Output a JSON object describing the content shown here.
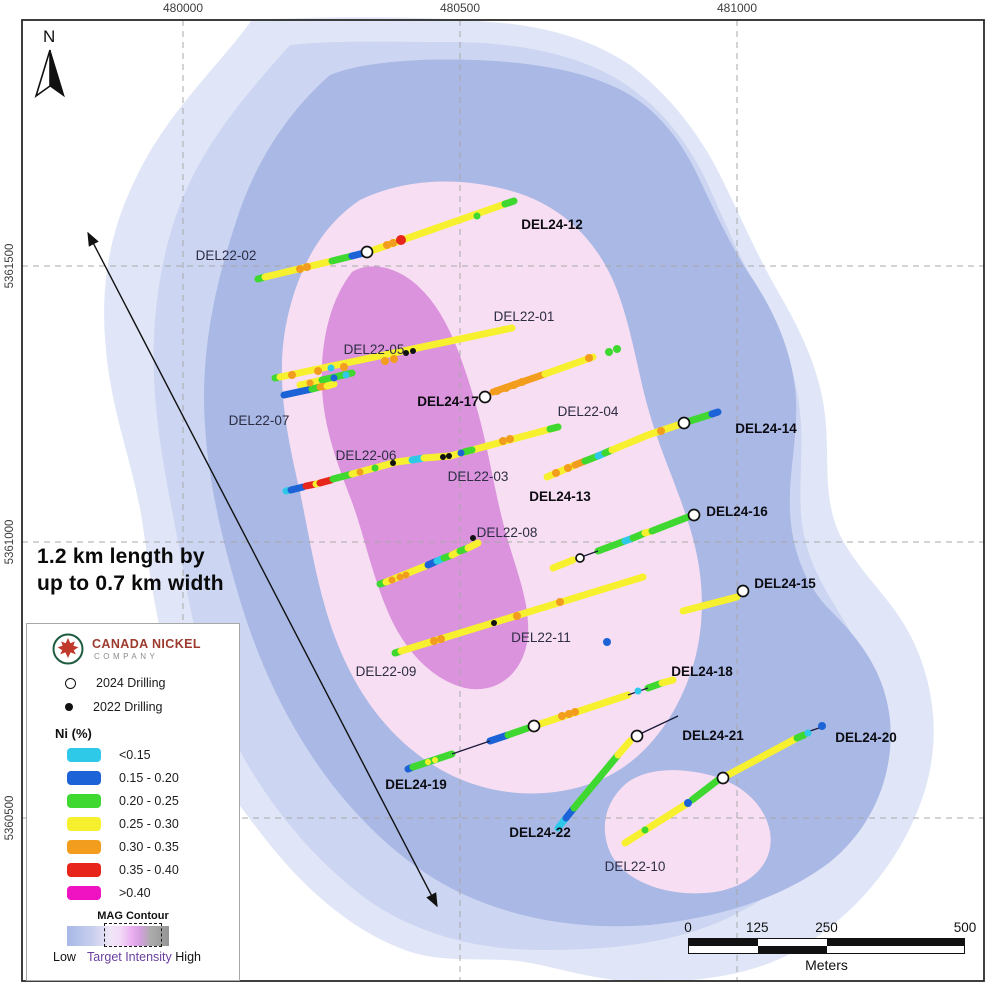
{
  "map": {
    "annotation": {
      "line1": "1.2 km length by",
      "line2": "up to 0.7 km width"
    },
    "north_label": "N",
    "axes": {
      "top_ticks": [
        {
          "label": "480000",
          "x": 183
        },
        {
          "label": "480500",
          "x": 460
        },
        {
          "label": "481000",
          "x": 737
        }
      ],
      "left_ticks": [
        {
          "label": "5361500",
          "y": 266
        },
        {
          "label": "5361000",
          "y": 542
        },
        {
          "label": "5360500",
          "y": 818
        }
      ]
    },
    "gridlines": {
      "vertical_x": [
        183,
        460,
        737
      ],
      "horizontal_y": [
        266,
        542,
        818
      ],
      "color": "#a9a9a9"
    },
    "frame": {
      "x": 22,
      "y": 20,
      "w": 962,
      "h": 961,
      "color": "#2a2a2a"
    },
    "arrow": {
      "x1": 88,
      "y1": 233,
      "x2": 437,
      "y2": 906
    },
    "class_colors": {
      "cyan": "#2ec9e9",
      "blue": "#1b63d6",
      "green": "#3ed830",
      "yellow": "#f7f02e",
      "orange": "#f29d1d",
      "red": "#e8251a",
      "magenta": "#f013c2",
      "black": "#111111"
    },
    "contours": [
      {
        "name": "mag-outer",
        "color": "#e0e6f7",
        "path": "M252,20 C215,70 165,115 135,180 C108,235 100,290 106,350 C112,415 132,460 142,520 C150,575 158,640 180,700 C200,755 235,800 270,845 C305,888 350,930 405,950 C445,965 490,956 525,962 C560,968 600,982 645,982 C700,982 760,975 805,945 C860,910 905,855 925,790 C940,740 935,690 915,645 C895,600 860,575 840,535 C822,498 830,455 825,415 C820,370 800,330 780,295 C758,258 740,215 720,175 C700,135 670,95 630,65 C590,38 540,25 490,22 C420,16 330,16 252,20 Z"
      },
      {
        "name": "mag-light",
        "color": "#ccd5f1",
        "path": "M290,45 C250,90 205,140 180,205 C158,262 150,330 155,395 C160,462 175,520 185,580 C196,645 215,705 245,760 C275,812 315,860 365,898 C415,934 478,950 540,950 C605,950 670,945 728,918 C785,890 838,848 865,790 C888,740 882,688 858,645 C838,608 815,580 805,540 C795,498 805,455 800,412 C795,365 778,325 758,290 C738,255 722,215 705,178 C685,138 658,105 622,82 C575,52 510,42 450,42 C390,42 335,40 290,45 Z"
      },
      {
        "name": "mag-medium",
        "color": "#a9b8e4",
        "path": "M330,75 C290,110 255,160 235,225 C215,285 200,355 205,425 C208,480 222,540 240,600 C258,660 285,720 325,775 C362,825 410,870 465,895 C520,920 585,930 650,925 C715,918 780,900 830,862 C872,828 895,775 890,720 C885,672 860,640 830,610 C805,585 792,550 790,512 C788,470 800,430 795,388 C790,345 772,308 750,275 C728,242 712,205 695,170 C676,132 648,100 610,85 C560,62 480,58 420,60 C385,62 355,65 330,75 Z"
      },
      {
        "name": "mag-target-pink",
        "color": "#f8def2",
        "path": "M360,200 C318,228 295,275 285,330 C276,385 288,440 300,492 C310,540 318,595 338,645 C360,700 395,745 445,772 C492,797 548,800 595,782 C640,765 672,725 690,675 C706,630 705,580 692,535 C680,492 660,452 648,408 C636,365 630,318 612,278 C592,235 558,205 515,192 C462,176 405,178 360,200 Z"
      },
      {
        "name": "mag-target-pink-south",
        "color": "#f8def2",
        "path": "M628,782 C605,800 598,830 612,856 C628,884 672,898 715,892 C752,886 775,862 770,832 C764,800 735,778 695,772 C670,768 645,770 628,782 Z"
      },
      {
        "name": "mag-core",
        "color": "#da93dc",
        "path": "M352,272 C330,300 320,342 322,388 C324,430 338,465 352,502 C364,535 372,575 388,612 C404,650 432,680 465,688 C498,695 525,672 528,635 C530,600 515,568 505,530 C494,490 488,445 475,402 C462,358 448,315 420,288 C400,268 372,260 352,272 Z"
      }
    ],
    "traces": {
      "segments": [
        [
          258,
          279,
          265,
          277,
          "green"
        ],
        [
          265,
          277,
          332,
          261,
          "yellow"
        ],
        [
          332,
          261,
          352,
          256,
          "green"
        ],
        [
          352,
          256,
          364,
          253,
          "blue"
        ],
        [
          371,
          251,
          505,
          204,
          "yellow"
        ],
        [
          505,
          204,
          514,
          201,
          "green"
        ],
        [
          275,
          378,
          280,
          377,
          "green"
        ],
        [
          280,
          377,
          512,
          328,
          "yellow"
        ],
        [
          300,
          385,
          322,
          380,
          "yellow"
        ],
        [
          322,
          380,
          352,
          373,
          "green"
        ],
        [
          284,
          395,
          312,
          389,
          "blue"
        ],
        [
          312,
          389,
          320,
          387,
          "green"
        ],
        [
          320,
          387,
          327,
          386,
          "orange"
        ],
        [
          327,
          386,
          334,
          384,
          "yellow"
        ],
        [
          493,
          392,
          545,
          374,
          "orange"
        ],
        [
          545,
          374,
          593,
          357,
          "yellow"
        ],
        [
          286,
          491,
          291,
          490,
          "cyan"
        ],
        [
          291,
          490,
          303,
          487,
          "blue"
        ],
        [
          306,
          486,
          316,
          484,
          "red"
        ],
        [
          316,
          484,
          320,
          483,
          "yellow"
        ],
        [
          320,
          483,
          331,
          480,
          "red"
        ],
        [
          333,
          479,
          352,
          474,
          "green"
        ],
        [
          352,
          474,
          393,
          463,
          "yellow"
        ],
        [
          396,
          462,
          412,
          460,
          "yellow"
        ],
        [
          412,
          460,
          424,
          458,
          "cyan"
        ],
        [
          424,
          458,
          450,
          456,
          "yellow"
        ],
        [
          450,
          456,
          558,
          427,
          "yellow"
        ],
        [
          464,
          452,
          472,
          450,
          "green"
        ],
        [
          550,
          429,
          558,
          427,
          "green"
        ],
        [
          547,
          477,
          575,
          465,
          "yellow"
        ],
        [
          575,
          465,
          585,
          461,
          "orange"
        ],
        [
          585,
          461,
          598,
          456,
          "green"
        ],
        [
          598,
          456,
          605,
          453,
          "cyan"
        ],
        [
          605,
          453,
          612,
          450,
          "green"
        ],
        [
          612,
          450,
          648,
          435,
          "yellow"
        ],
        [
          648,
          435,
          678,
          425,
          "yellow"
        ],
        [
          690,
          421,
          712,
          414,
          "green"
        ],
        [
          712,
          414,
          718,
          412,
          "blue"
        ],
        [
          380,
          584,
          386,
          582,
          "green"
        ],
        [
          386,
          582,
          428,
          565,
          "yellow"
        ],
        [
          428,
          565,
          437,
          561,
          "blue"
        ],
        [
          437,
          561,
          444,
          558,
          "cyan"
        ],
        [
          444,
          558,
          452,
          555,
          "green"
        ],
        [
          452,
          555,
          460,
          551,
          "yellow"
        ],
        [
          460,
          551,
          468,
          548,
          "green"
        ],
        [
          468,
          548,
          478,
          543,
          "yellow"
        ],
        [
          553,
          568,
          573,
          560,
          "yellow"
        ],
        [
          598,
          551,
          625,
          541,
          "green"
        ],
        [
          625,
          541,
          633,
          538,
          "cyan"
        ],
        [
          633,
          538,
          645,
          533,
          "green"
        ],
        [
          645,
          533,
          652,
          531,
          "yellow"
        ],
        [
          652,
          531,
          688,
          517,
          "green"
        ],
        [
          395,
          653,
          401,
          651,
          "green"
        ],
        [
          401,
          651,
          643,
          577,
          "yellow"
        ],
        [
          683,
          611,
          737,
          597,
          "yellow"
        ],
        [
          408,
          769,
          413,
          767,
          "blue"
        ],
        [
          413,
          767,
          452,
          754,
          "green"
        ],
        [
          490,
          741,
          508,
          735,
          "blue"
        ],
        [
          508,
          735,
          528,
          728,
          "green"
        ],
        [
          540,
          724,
          628,
          695,
          "yellow"
        ],
        [
          648,
          688,
          662,
          683,
          "green"
        ],
        [
          662,
          683,
          673,
          680,
          "yellow"
        ],
        [
          558,
          828,
          566,
          818,
          "cyan"
        ],
        [
          566,
          818,
          574,
          808,
          "blue"
        ],
        [
          574,
          808,
          618,
          755,
          "green"
        ],
        [
          618,
          755,
          630,
          741,
          "yellow"
        ],
        [
          625,
          843,
          688,
          803,
          "yellow"
        ],
        [
          692,
          800,
          718,
          780,
          "green"
        ],
        [
          728,
          775,
          797,
          738,
          "yellow"
        ],
        [
          797,
          738,
          804,
          735,
          "green"
        ]
      ],
      "connectors": [
        [
          452,
          754,
          490,
          741
        ],
        [
          628,
          695,
          648,
          688
        ],
        [
          584,
          556,
          598,
          551
        ],
        [
          642,
          733,
          678,
          716
        ],
        [
          810,
          731,
          819,
          728
        ]
      ],
      "dots": [
        [
          300,
          269,
          "orange"
        ],
        [
          307,
          267,
          "orange"
        ],
        [
          387,
          245,
          "orange"
        ],
        [
          393,
          243,
          "orange"
        ],
        [
          401,
          240,
          "red",
          5
        ],
        [
          477,
          216,
          "green",
          3.5
        ],
        [
          292,
          375,
          "orange"
        ],
        [
          318,
          371,
          "orange"
        ],
        [
          344,
          367,
          "orange"
        ],
        [
          385,
          361,
          "orange"
        ],
        [
          394,
          359,
          "orange"
        ],
        [
          331,
          368,
          "cyan",
          3.5
        ],
        [
          310,
          383,
          "orange",
          3.5
        ],
        [
          334,
          378,
          "blue",
          3.5
        ],
        [
          346,
          375,
          "cyan",
          3.5
        ],
        [
          497,
          391,
          "orange"
        ],
        [
          506,
          388,
          "orange"
        ],
        [
          514,
          385,
          "orange"
        ],
        [
          522,
          382,
          "orange"
        ],
        [
          589,
          358,
          "orange"
        ],
        [
          609,
          352,
          "green",
          4
        ],
        [
          617,
          349,
          "green",
          4
        ],
        [
          360,
          472,
          "orange",
          3.5
        ],
        [
          375,
          468,
          "green",
          3.5
        ],
        [
          461,
          453,
          "blue",
          3.5
        ],
        [
          503,
          441,
          "orange"
        ],
        [
          510,
          439,
          "orange"
        ],
        [
          556,
          473,
          "orange"
        ],
        [
          568,
          468,
          "orange"
        ],
        [
          661,
          431,
          "orange"
        ],
        [
          392,
          580,
          "orange",
          3.5
        ],
        [
          400,
          577,
          "orange",
          3.5
        ],
        [
          406,
          575,
          "orange",
          3.5
        ],
        [
          434,
          641,
          "orange"
        ],
        [
          441,
          639,
          "orange"
        ],
        [
          517,
          616,
          "orange"
        ],
        [
          560,
          602,
          "orange"
        ],
        [
          428,
          762,
          "yellow",
          3
        ],
        [
          435,
          760,
          "yellow",
          3
        ],
        [
          562,
          716,
          "orange"
        ],
        [
          569,
          714,
          "orange"
        ],
        [
          575,
          712,
          "orange"
        ],
        [
          638,
          691,
          "cyan",
          3.5
        ],
        [
          645,
          830,
          "green",
          3.5
        ],
        [
          688,
          803,
          "blue",
          4
        ],
        [
          808,
          733,
          "cyan",
          3.5
        ],
        [
          822,
          726,
          "blue",
          4
        ],
        [
          607,
          642,
          "blue",
          4
        ]
      ],
      "collars_2024": [
        [
          367,
          252
        ],
        [
          485,
          397
        ],
        [
          684,
          423
        ],
        [
          694,
          515
        ],
        [
          580,
          558,
          4
        ],
        [
          743,
          591
        ],
        [
          534,
          726
        ],
        [
          637,
          736
        ],
        [
          723,
          778
        ]
      ],
      "collars_2022": [
        [
          406,
          353
        ],
        [
          413,
          351
        ],
        [
          393,
          463
        ],
        [
          443,
          457
        ],
        [
          449,
          456
        ],
        [
          473,
          538
        ],
        [
          494,
          623
        ]
      ]
    },
    "labels": [
      {
        "text": "DEL22-02",
        "x": 226,
        "y": 255,
        "bold": false
      },
      {
        "text": "DEL24-12",
        "x": 552,
        "y": 224,
        "bold": true
      },
      {
        "text": "DEL22-01",
        "x": 524,
        "y": 316,
        "bold": false
      },
      {
        "text": "DEL22-05",
        "x": 374,
        "y": 349,
        "bold": false
      },
      {
        "text": "DEL24-17",
        "x": 448,
        "y": 401,
        "bold": true
      },
      {
        "text": "DEL22-07",
        "x": 259,
        "y": 420,
        "bold": false
      },
      {
        "text": "DEL22-04",
        "x": 588,
        "y": 411,
        "bold": false
      },
      {
        "text": "DEL24-14",
        "x": 766,
        "y": 428,
        "bold": true
      },
      {
        "text": "DEL22-06",
        "x": 366,
        "y": 455,
        "bold": false
      },
      {
        "text": "DEL22-03",
        "x": 478,
        "y": 476,
        "bold": false
      },
      {
        "text": "DEL24-13",
        "x": 560,
        "y": 496,
        "bold": true
      },
      {
        "text": "DEL22-08",
        "x": 507,
        "y": 532,
        "bold": false
      },
      {
        "text": "DEL24-16",
        "x": 737,
        "y": 511,
        "bold": true
      },
      {
        "text": "DEL24-15",
        "x": 785,
        "y": 583,
        "bold": true
      },
      {
        "text": "DEL22-11",
        "x": 541,
        "y": 637,
        "bold": false
      },
      {
        "text": "DEL22-09",
        "x": 386,
        "y": 671,
        "bold": false
      },
      {
        "text": "DEL24-18",
        "x": 702,
        "y": 671,
        "bold": true
      },
      {
        "text": "DEL24-19",
        "x": 416,
        "y": 784,
        "bold": true
      },
      {
        "text": "DEL24-21",
        "x": 713,
        "y": 735,
        "bold": true
      },
      {
        "text": "DEL24-20",
        "x": 866,
        "y": 737,
        "bold": true
      },
      {
        "text": "DEL24-22",
        "x": 540,
        "y": 832,
        "bold": true
      },
      {
        "text": "DEL22-10",
        "x": 635,
        "y": 866,
        "bold": false
      }
    ],
    "scalebar": {
      "ticks": [
        {
          "label": "0",
          "f": 0
        },
        {
          "label": "125",
          "f": 0.25
        },
        {
          "label": "250",
          "f": 0.5
        },
        {
          "label": "500",
          "f": 1
        }
      ],
      "segments_top": [
        "#111",
        "#fff",
        "#111"
      ],
      "segments_bottom": [
        "#fff",
        "#111",
        "#fff"
      ],
      "fractions": [
        0.25,
        0.25,
        0.5
      ],
      "unit": "Meters"
    }
  },
  "legend": {
    "logo": {
      "line1": "CANADA NICKEL",
      "line2": "COMPANY",
      "ring_color": "#1f5c42",
      "leaf_color": "#c0392b"
    },
    "drilling": [
      {
        "symbol": "open",
        "label": "2024 Drilling"
      },
      {
        "symbol": "filled",
        "label": "2022 Drilling"
      }
    ],
    "ni_title": "Ni (%)",
    "ni_classes": [
      {
        "label": "<0.15",
        "color": "#2ec9e9"
      },
      {
        "label": "0.15 - 0.20",
        "color": "#1b63d6"
      },
      {
        "label": "0.20 - 0.25",
        "color": "#3ed830"
      },
      {
        "label": "0.25 - 0.30",
        "color": "#f7f02e"
      },
      {
        "label": "0.30 - 0.35",
        "color": "#f29d1d"
      },
      {
        "label": "0.35 - 0.40",
        "color": "#e8251a"
      },
      {
        "label": ">0.40",
        "color": "#f013c2"
      }
    ],
    "mag": {
      "title": "MAG Contour",
      "low": "Low",
      "target": "Target Intensity",
      "high": "High",
      "target_color": "#6b3fa0"
    }
  }
}
